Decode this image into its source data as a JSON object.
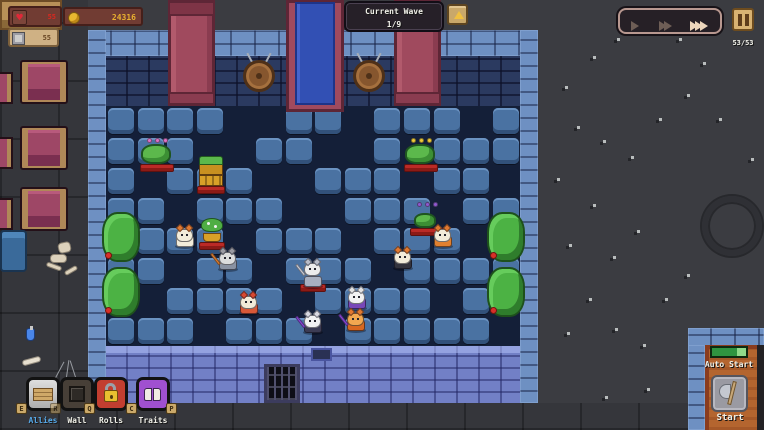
{
  "icons": {
    "heart": "♥"
  },
  "hud": {
    "hp": {
      "value": "55"
    },
    "gold": {
      "value": "24316"
    },
    "capacity": {
      "value": "55"
    },
    "wave": {
      "label": "Current Wave",
      "value": "1/9"
    },
    "speed": {
      "levels": [
        {
          "name": "play",
          "active": false
        },
        {
          "name": "fast-forward",
          "active": false
        },
        {
          "name": "fastest-forward",
          "active": true
        }
      ]
    },
    "unit_count": "53/53",
    "auto_start": {
      "label": "Auto Start",
      "progress_percent": 78
    },
    "start_label": "Start"
  },
  "action_bar": {
    "items": [
      {
        "id": "allies",
        "label": "Allies",
        "hotkey": "E",
        "label_color": "#56a8e8"
      },
      {
        "id": "wall",
        "label": "Wall",
        "hotkey": "R",
        "label_color": "#ece8dc"
      },
      {
        "id": "rolls",
        "label": "Rolls",
        "hotkey": "Q",
        "label_color": "#ece8dc"
      },
      {
        "id": "traits",
        "label": "Traits",
        "hotkey": "C",
        "hotkey2": "P",
        "label_color": "#ece8dc"
      }
    ]
  },
  "arena": {
    "tile_grid": [
      "11110011011101",
      "11100110010111",
      "10111001110110",
      "11011100111011",
      "01110111011101",
      "11011011101111",
      "10111101111011",
      "11101110111110"
    ]
  },
  "units": [
    {
      "name": "blossom-blob",
      "type": "blob",
      "ally": false,
      "pedestal": true,
      "x": 140,
      "y": 136,
      "accent": "#e070c8"
    },
    {
      "name": "gift-crates",
      "type": "crates",
      "ally": false,
      "pedestal": true,
      "x": 197,
      "y": 148
    },
    {
      "name": "coin-blob",
      "type": "blob",
      "ally": false,
      "pedestal": true,
      "x": 404,
      "y": 136,
      "accent": "#f0c838"
    },
    {
      "name": "green-imp",
      "type": "blob",
      "small": true,
      "ally": false,
      "pedestal": true,
      "x": 410,
      "y": 200,
      "accent": "#9058d0"
    },
    {
      "name": "potted-sprout",
      "type": "plant",
      "ally": false,
      "pedestal": true,
      "x": 199,
      "y": 216
    },
    {
      "name": "fox-scout",
      "type": "cat",
      "ally": true,
      "x": 172,
      "y": 224,
      "head": "#f2ecda",
      "ears": "#e07830",
      "body": "#f2ecda"
    },
    {
      "name": "grey-cat",
      "type": "cat",
      "ally": true,
      "x": 215,
      "y": 247,
      "head": "#dcdcdc",
      "ears": "#9a9aa2",
      "body": "#8a92a2",
      "weapon": "#e08030"
    },
    {
      "name": "red-cat",
      "type": "cat",
      "ally": true,
      "x": 236,
      "y": 291,
      "head": "#f2ead8",
      "ears": "#d84830",
      "body": "#d85838"
    },
    {
      "name": "knight-cat",
      "type": "cat",
      "ally": true,
      "pedestal": true,
      "x": 300,
      "y": 258,
      "head": "#ececec",
      "ears": "#b8bcc8",
      "body": "#a8b0c0",
      "weapon": "#ccd0da"
    },
    {
      "name": "cape-cat",
      "type": "cat",
      "ally": true,
      "x": 344,
      "y": 286,
      "head": "#f2f2f2",
      "ears": "#e4e4e4",
      "body": "#7848b8"
    },
    {
      "name": "blade-cat",
      "type": "cat",
      "ally": true,
      "x": 300,
      "y": 310,
      "head": "#f2f2f2",
      "ears": "#d8d8e0",
      "body": "#3c3c54",
      "weapon": "#8a48d8"
    },
    {
      "name": "pumpkin-cat",
      "type": "cat",
      "ally": true,
      "x": 343,
      "y": 308,
      "head": "#f2a850",
      "ears": "#e07830",
      "body": "#d86820",
      "weapon": "#8a48d8"
    },
    {
      "name": "fox-b",
      "type": "cat",
      "ally": true,
      "x": 390,
      "y": 246,
      "head": "#f2ecda",
      "ears": "#e07830",
      "body": "#34343e"
    },
    {
      "name": "fox-tail",
      "type": "cat",
      "ally": true,
      "x": 430,
      "y": 224,
      "head": "#f2ecda",
      "ears": "#e07830",
      "body": "#e08030"
    }
  ],
  "colors": {
    "floor_tile": "#4a72a2",
    "wall_brick": "#6e90c2",
    "enemy_pedestal": "#bb2a26",
    "gold_text": "#e8b030",
    "hp_text": "#d82820"
  }
}
